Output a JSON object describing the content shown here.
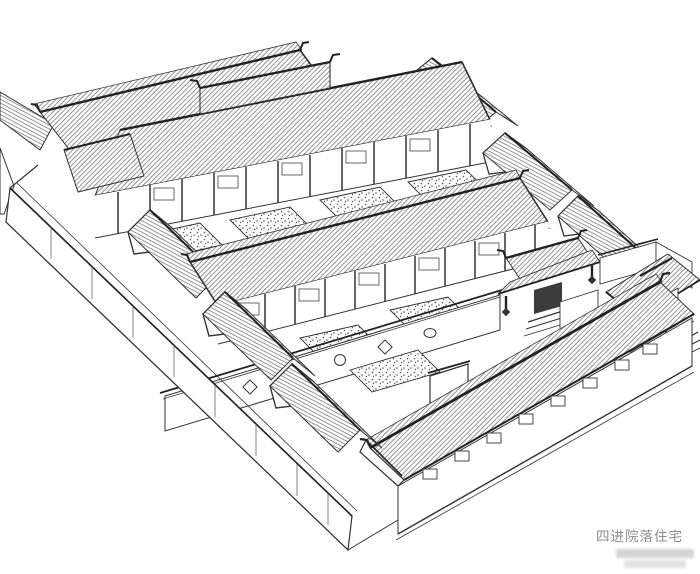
{
  "page": {
    "background_color": "#ffffff"
  },
  "caption": {
    "text": "四进院落住宅",
    "color": "#8c8c8c"
  },
  "watermark": {
    "present": true,
    "legible": false
  },
  "drawing": {
    "ink_color": "#333333",
    "heavy_line_color": "#222222",
    "hatch_color": "#707070",
    "stipple_color": "#555555"
  }
}
